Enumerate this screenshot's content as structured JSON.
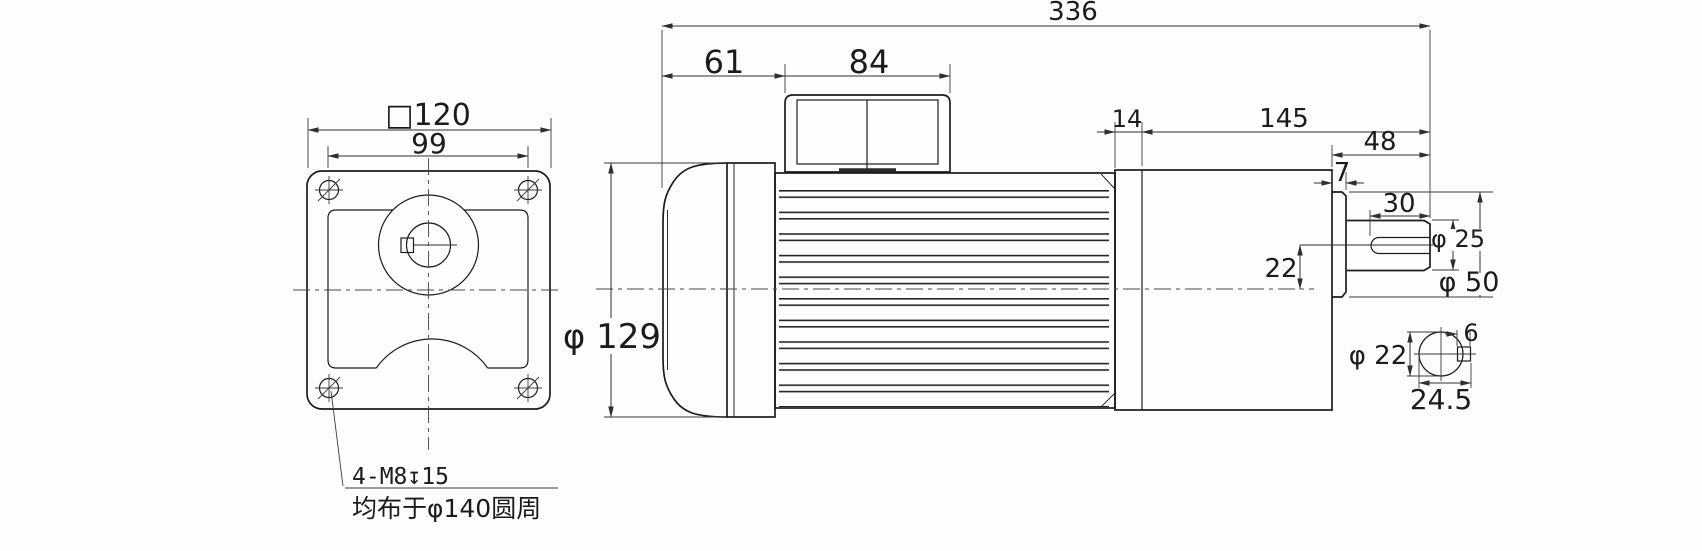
{
  "drawing": {
    "title_hint": "gearmotor-dimension-drawing",
    "front_view": {
      "flange_size": "□120",
      "bolt_spacing": "99",
      "note_line1": "4-M8↧15",
      "note_line2": "均布于φ140圆周"
    },
    "side_view": {
      "overall_length": "336",
      "rear_cap_length": "61",
      "terminal_box_width": "84",
      "motor_diameter": "φ 129",
      "adapter_width": "14",
      "gearbox_length": "145",
      "shaft_extension": "48",
      "boss_width": "7",
      "keyway_length": "30",
      "shaft_axis_offset": "22",
      "shaft_diameter": "φ 25",
      "boss_diameter": "φ 50"
    },
    "shaft_section": {
      "shaft_diameter": "φ 22",
      "key_width": "6",
      "width_across_key": "24.5"
    },
    "style": {
      "line_color": "#1c1c1c",
      "background": "#fdfdfd"
    }
  }
}
